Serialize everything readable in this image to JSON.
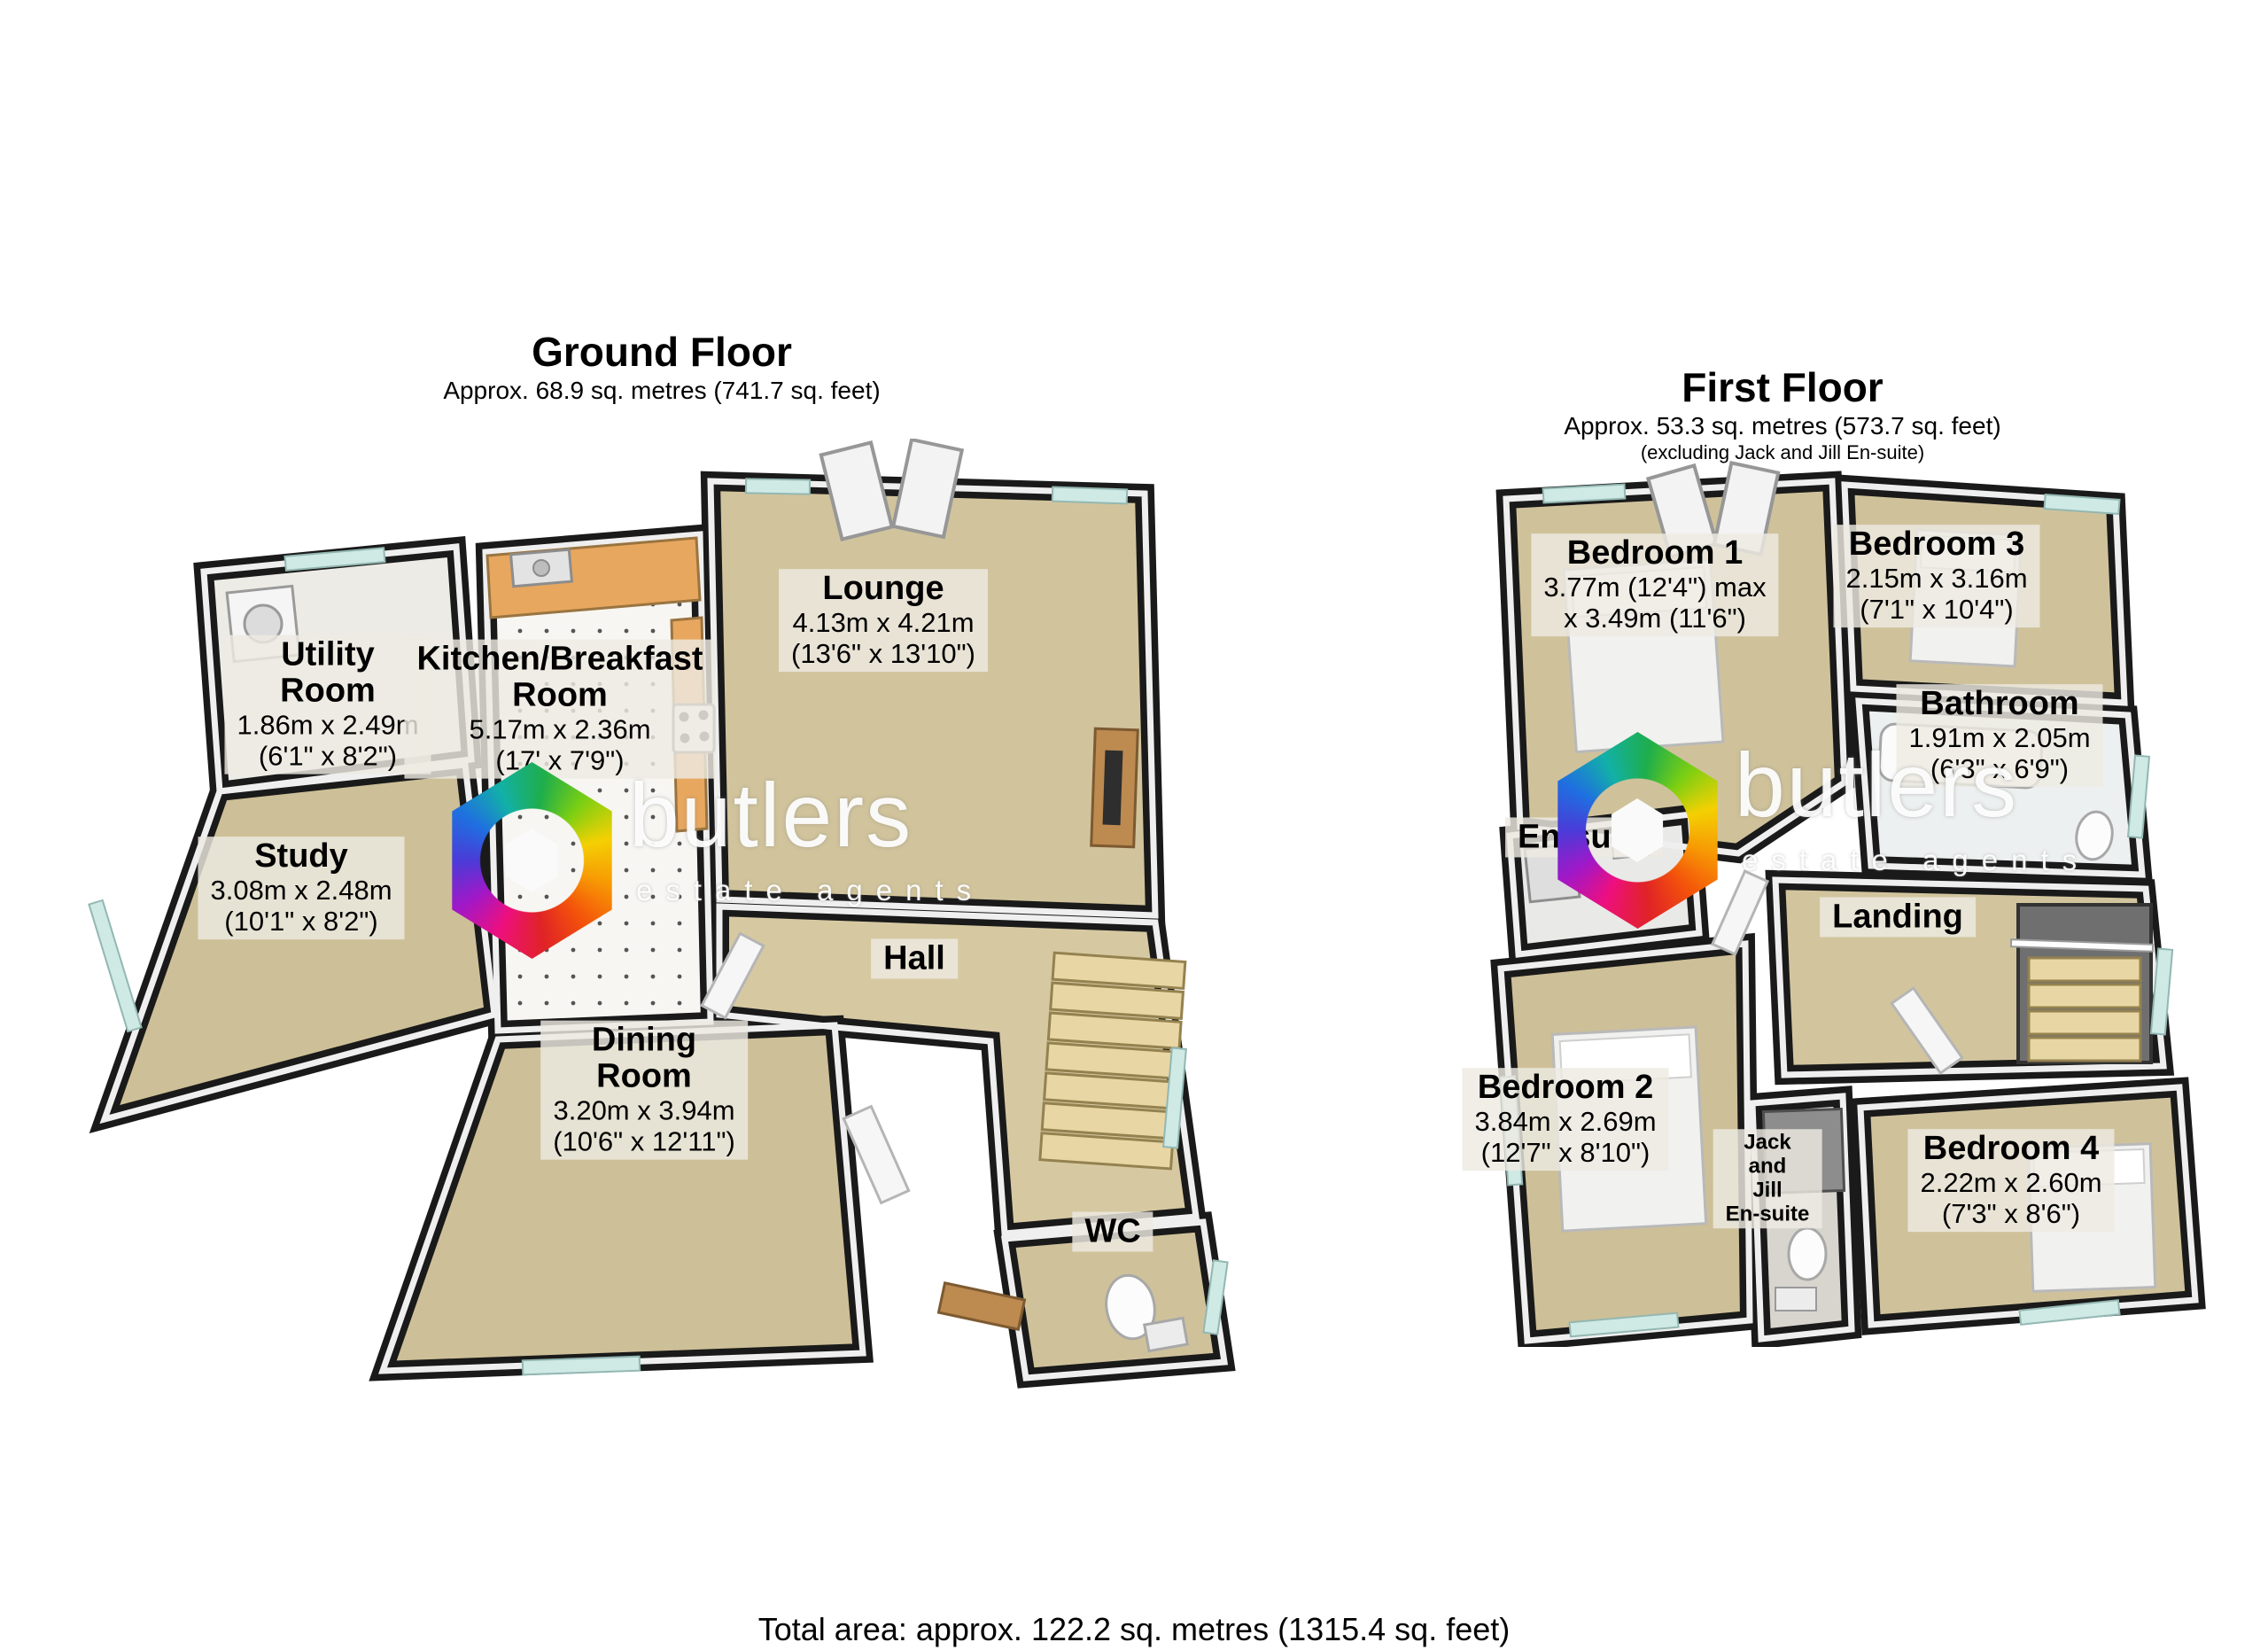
{
  "ground_floor": {
    "title": "Ground Floor",
    "subtitle": "Approx. 68.9 sq. metres (741.7 sq. feet)",
    "rooms": [
      {
        "name": "Utility\nRoom",
        "metric": "1.86m x 2.49m",
        "imperial": "(6'1\" x 8'2\")"
      },
      {
        "name": "Kitchen/Breakfast\nRoom",
        "metric": "5.17m x 2.36m",
        "imperial": "(17' x 7'9\")"
      },
      {
        "name": "Lounge",
        "metric": "4.13m x 4.21m",
        "imperial": "(13'6\" x 13'10\")"
      },
      {
        "name": "Study",
        "metric": "3.08m x 2.48m",
        "imperial": "(10'1\" x 8'2\")"
      },
      {
        "name": "Dining\nRoom",
        "metric": "3.20m x 3.94m",
        "imperial": "(10'6\" x 12'11\")"
      },
      {
        "name": "Hall"
      },
      {
        "name": "WC"
      }
    ]
  },
  "first_floor": {
    "title": "First Floor",
    "subtitle": "Approx. 53.3 sq. metres (573.7 sq. feet)",
    "note": "(excluding Jack and Jill En-suite)",
    "rooms": [
      {
        "name": "Bedroom 1",
        "metric": "3.77m (12'4\") max",
        "imperial": "x 3.49m (11'6\")"
      },
      {
        "name": "Bedroom 3",
        "metric": "2.15m x 3.16m",
        "imperial": "(7'1\" x 10'4\")"
      },
      {
        "name": "Bathroom",
        "metric": "1.91m x 2.05m",
        "imperial": "(6'3\" x 6'9\")"
      },
      {
        "name": "En-suite"
      },
      {
        "name": "Landing"
      },
      {
        "name": "Bedroom 2",
        "metric": "3.84m x 2.69m",
        "imperial": "(12'7\" x 8'10\")"
      },
      {
        "name": "Jack\nand\nJill\nEn-suite"
      },
      {
        "name": "Bedroom 4",
        "metric": "2.22m x 2.60m",
        "imperial": "(7'3\" x 8'6\")"
      }
    ]
  },
  "footer": {
    "total": "Total area: approx. 122.2 sq. metres (1315.4 sq. feet)"
  },
  "watermark": {
    "wordmark": "butlers",
    "tagline": "estate agents"
  },
  "colors": {
    "wall": "#1a1a1a",
    "floor_carpet": "#cfc29b",
    "window_glass": "#cfe9e5",
    "counter_wood": "#e7a75f",
    "label_background": "#edeae2"
  }
}
